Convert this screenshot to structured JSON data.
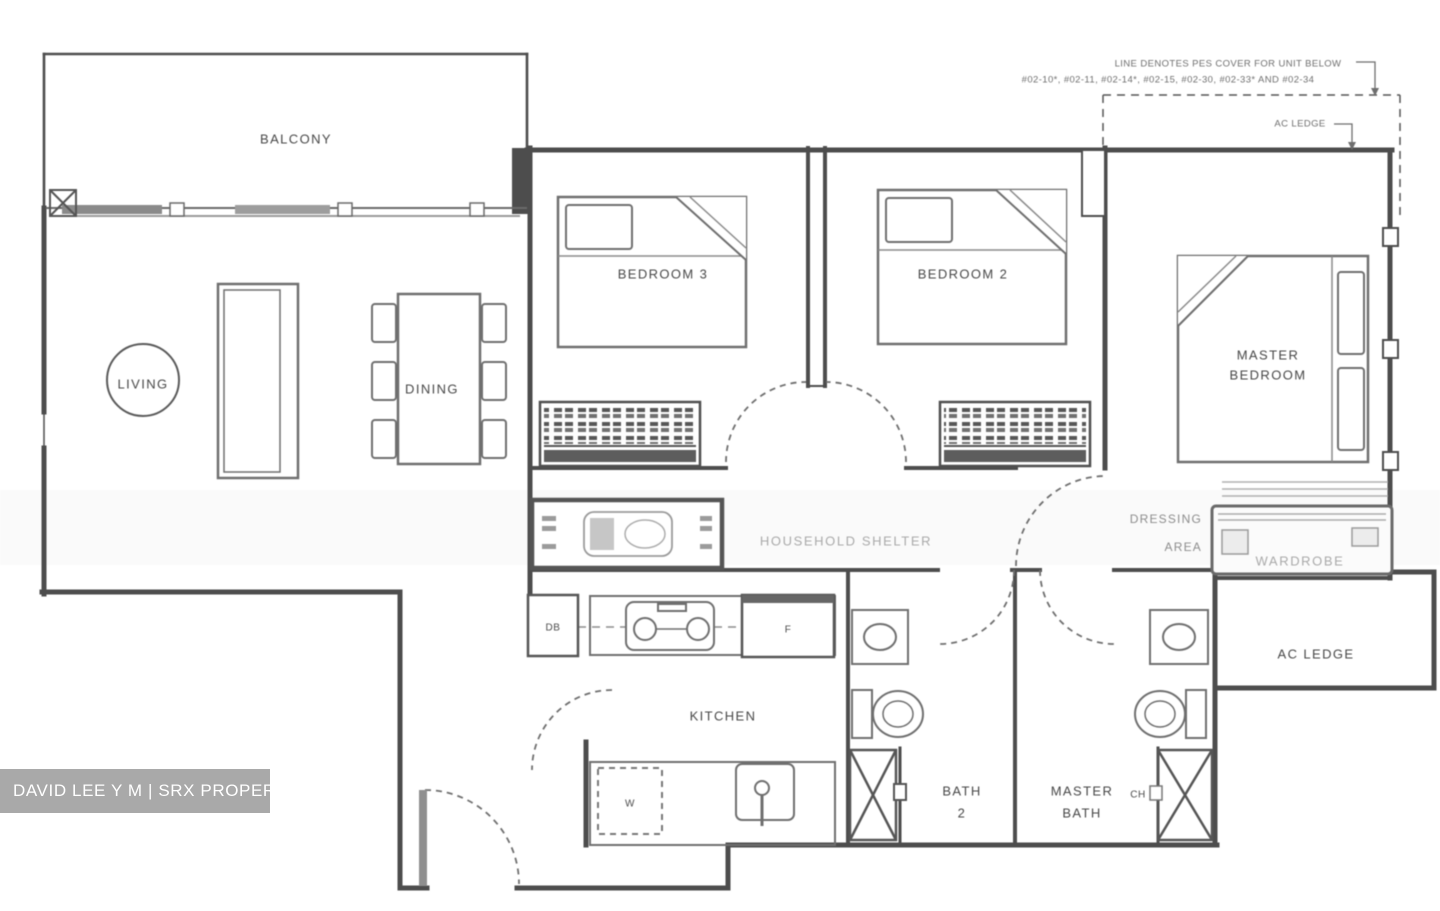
{
  "title": "3-bedroom unit floor plan",
  "watermark": {
    "text": "DAVID LEE Y M | SRX PROPERTY"
  },
  "annotations": {
    "pes_note_line1": "LINE DENOTES PES COVER FOR UNIT BELOW",
    "pes_note_line2": "#02-10*, #02-11, #02-14*, #02-15, #02-30, #02-33* AND #02-34",
    "ac_ledge_callout": "AC LEDGE"
  },
  "rooms": {
    "balcony": "BALCONY",
    "living": "LIVING",
    "dining": "DINING",
    "bedroom3": "BEDROOM 3",
    "bedroom2": "BEDROOM 2",
    "master_bedroom_line1": "MASTER",
    "master_bedroom_line2": "BEDROOM",
    "kitchen": "KITCHEN",
    "bath2_line1": "BATH",
    "bath2_line2": "2",
    "master_bath_line1": "MASTER",
    "master_bath_line2": "BATH",
    "ac_ledge": "AC LEDGE",
    "hallway_faint": "HOUSEHOLD SHELTER",
    "dressing_line1": "DRESSING",
    "dressing_line2": "AREA",
    "wardrobe_faint": "WARDROBE"
  },
  "fixtures": {
    "db": "DB",
    "fridge": "F",
    "washer": "W",
    "ch": "CH"
  },
  "colors": {
    "wall": "#4d4d4d",
    "furniture": "#6f6f6f",
    "label_text": "#474747",
    "faint_text": "#a9a9a9",
    "watermark_bg": "#a9a9a9",
    "watermark_text": "#ffffff"
  }
}
